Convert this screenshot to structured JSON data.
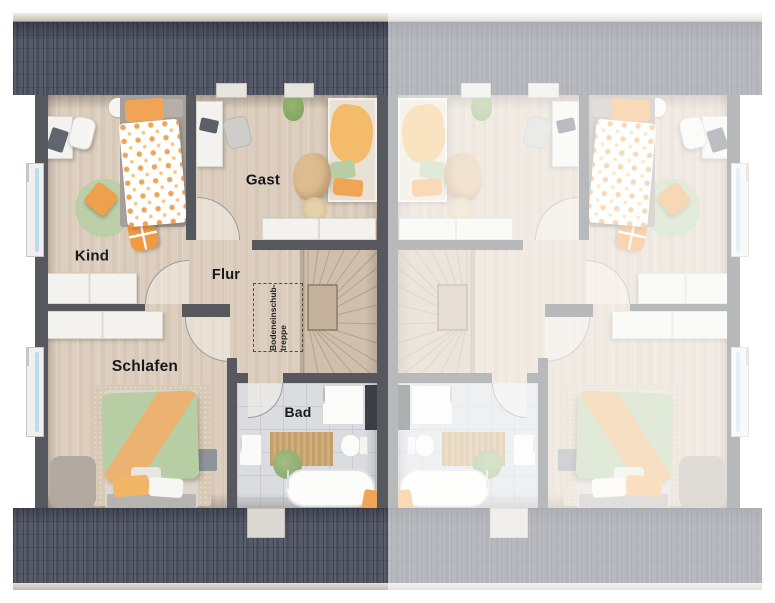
{
  "floor_plan": {
    "units": [
      {
        "id": "left",
        "rendering": "full-color"
      },
      {
        "id": "right",
        "rendering": "mirrored-faded"
      }
    ],
    "rooms": [
      {
        "id": "kind",
        "label": "Kind"
      },
      {
        "id": "gast",
        "label": "Gast"
      },
      {
        "id": "flur",
        "label": "Flur"
      },
      {
        "id": "schlafen",
        "label": "Schlafen"
      },
      {
        "id": "bad",
        "label": "Bad"
      }
    ],
    "annotation": {
      "line1": "Bodeneinschub-",
      "line2": "treppe"
    },
    "colors": {
      "roof": "#4d5160",
      "wall": "#57585e",
      "floor_wood": "#ddcfbf",
      "stairs_wood": "#cfc0ad",
      "bath_tile": "#dadcdf",
      "accent_orange": "#f0a455",
      "accent_green": "#b7cda4",
      "window_glass": "#badcec",
      "sill_wood": "#c79e63"
    }
  }
}
